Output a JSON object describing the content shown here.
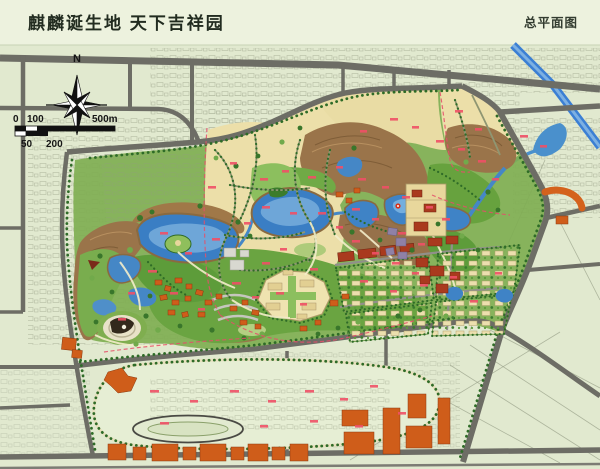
{
  "header": {
    "title": "麒麟诞生地 天下吉祥园",
    "plan_label": "总平面图"
  },
  "map": {
    "north_label": "N",
    "scale_bar": {
      "tick_zero": "0",
      "tick_100": "100",
      "tick_500": "500m",
      "tick_50": "50",
      "tick_200": "200"
    },
    "colors": {
      "header_background": "#edf2de",
      "map_background": "#e1e9cf",
      "road_gray": "#6d6d65",
      "water_blue": "#4587c6",
      "river_blue": "#3b7fd4",
      "park_green": "#7fae52",
      "terrain_brown": "#9a744a",
      "plot_tan": "#ecdfa9",
      "building_orange": "#cf5d1a",
      "label_red": "#ef5066",
      "boundary_dash_red": "#e4506a"
    }
  }
}
